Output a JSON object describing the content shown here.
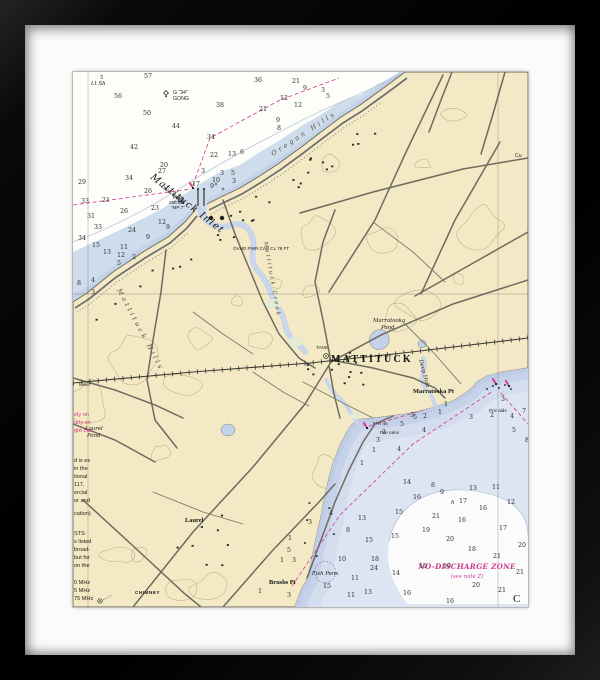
{
  "artwork": {
    "type_note": "framed nautical chart print",
    "frame_color": "#0c0c0c",
    "mat_color": "#fbfbfa",
    "colors": {
      "land": "#f3e9c4",
      "shallow_sound": "#cfdcec",
      "bay_pale": "#dde4f2",
      "bay_shallow": "#c6d2e9",
      "creek": "#c8d5ea",
      "marsh": "#e3ecd2",
      "magenta": "#cf3a8e",
      "road": "#6f6b60",
      "contour": "#b1a67c"
    }
  },
  "chart": {
    "labels": [
      {
        "t": "Mattituck Inlet",
        "x": 77,
        "y": 106,
        "cls": "inlet",
        "rot": 38
      },
      {
        "t": "(see inset)",
        "x": 88,
        "y": 115,
        "cls": "tiny-it",
        "rot": 38
      },
      {
        "t": "G “34”",
        "x": 100,
        "y": 22,
        "cls": "tiny"
      },
      {
        "t": "GONG",
        "x": 100,
        "y": 28,
        "cls": "tiny"
      },
      {
        "t": "5",
        "x": 27,
        "y": 7,
        "cls": "sd2"
      },
      {
        "t": "Lt Sh",
        "x": 18,
        "y": 13,
        "cls": "tiny-it"
      },
      {
        "t": "Fl 4s",
        "x": 100,
        "y": 127,
        "cls": "tiny4"
      },
      {
        "t": "25ft 6M",
        "x": 96,
        "y": 132,
        "cls": "tiny4"
      },
      {
        "t": "“MP 7”",
        "x": 98,
        "y": 137,
        "cls": "tiny4"
      },
      {
        "t": "Oregon Hills",
        "x": 200,
        "y": 84,
        "cls": "spread",
        "rot": -33
      },
      {
        "t": "Mattituck Hills",
        "x": 44,
        "y": 218,
        "cls": "spread",
        "rot": 62
      },
      {
        "t": "Mattituck Creek",
        "x": 191,
        "y": 170,
        "cls": "spread2",
        "rot": 80
      },
      {
        "t": "OVHD PWR CAB CL 78 FT",
        "x": 160,
        "y": 178,
        "cls": "tiny4"
      },
      {
        "t": "MATTITUCK",
        "x": 258,
        "y": 290,
        "cls": "town"
      },
      {
        "t": "TANK",
        "x": 243,
        "y": 277,
        "cls": "tiny4"
      },
      {
        "t": "Marratooka",
        "x": 300,
        "y": 250,
        "cls": "tiny-it"
      },
      {
        "t": "Pond",
        "x": 308,
        "y": 257,
        "cls": "tiny-it"
      },
      {
        "t": "Marratooka Pt",
        "x": 340,
        "y": 321,
        "cls": "ptlabel"
      },
      {
        "t": "Deep Hole",
        "x": 346,
        "y": 288,
        "cls": "tiny-it",
        "rot": 75
      },
      {
        "t": "Priv aids",
        "x": 416,
        "y": 340,
        "cls": "tiny4"
      },
      {
        "t": "Pile ruins",
        "x": 307,
        "y": 362,
        "cls": "tiny4"
      },
      {
        "t": "Fl R 4s",
        "x": 300,
        "y": 353,
        "cls": "tiny4"
      },
      {
        "t": "Brushs Pt",
        "x": 196,
        "y": 512,
        "cls": "ptlabel"
      },
      {
        "t": "Laurel",
        "x": 112,
        "y": 450,
        "cls": "ptlabel"
      },
      {
        "t": "Laurel",
        "x": 12,
        "y": 358,
        "cls": "tiny-it"
      },
      {
        "t": "Pond",
        "x": 14,
        "y": 365,
        "cls": "tiny-it"
      },
      {
        "t": "Fish Pens",
        "x": 252,
        "y": 503,
        "cls": "tiny-it",
        "a": "m"
      },
      {
        "t": "NO-DISCHARGE ZONE",
        "x": 394,
        "y": 497,
        "cls": "ndz",
        "a": "m"
      },
      {
        "t": "(see note Z)",
        "x": 394,
        "y": 506,
        "cls": "ndz2",
        "a": "m"
      },
      {
        "t": "CHIMNEY",
        "x": 62,
        "y": 522,
        "cls": "tiny4b"
      },
      {
        "t": "tower",
        "x": 6,
        "y": 314,
        "cls": "tiny4"
      },
      {
        "t": "Cu",
        "x": 442,
        "y": 85,
        "cls": "tiny"
      },
      {
        "t": "C",
        "x": 440,
        "y": 530,
        "cls": "bigC"
      },
      {
        "t": "ely on",
        "x": 1,
        "y": 344,
        "cls": "notem"
      },
      {
        "t": "arly on",
        "x": 1,
        "y": 352,
        "cls": "notem"
      },
      {
        "t": "ght List",
        "x": 1,
        "y": 360,
        "cls": "notem"
      },
      {
        "t": "d is es",
        "x": 1,
        "y": 390,
        "cls": "note"
      },
      {
        "t": "in the",
        "x": 1,
        "y": 398,
        "cls": "note"
      },
      {
        "t": "tional",
        "x": 1,
        "y": 406,
        "cls": "note"
      },
      {
        "t": "117,",
        "x": 1,
        "y": 414,
        "cls": "note"
      },
      {
        "t": "ercial",
        "x": 1,
        "y": 422,
        "cls": "note"
      },
      {
        "t": "or and",
        "x": 1,
        "y": 430,
        "cls": "note"
      },
      {
        "t": "cation)",
        "x": 1,
        "y": 443,
        "cls": "note"
      },
      {
        "t": "STS",
        "x": 1,
        "y": 463,
        "cls": "note"
      },
      {
        "t": "s listed",
        "x": 1,
        "y": 471,
        "cls": "note"
      },
      {
        "t": "broad-",
        "x": 1,
        "y": 479,
        "cls": "note"
      },
      {
        "t": "but for",
        "x": 1,
        "y": 487,
        "cls": "note"
      },
      {
        "t": "on the",
        "x": 1,
        "y": 495,
        "cls": "note"
      },
      {
        "t": "0 MHz",
        "x": 1,
        "y": 512,
        "cls": "note"
      },
      {
        "t": "5 MHz",
        "x": 1,
        "y": 520,
        "cls": "note"
      },
      {
        "t": "75 MHz",
        "x": 1,
        "y": 528,
        "cls": "note"
      },
      {
        "t": "h",
        "x": 378,
        "y": 432,
        "cls": "tiny-it"
      }
    ],
    "soundings": [
      {
        "v": "57",
        "x": 71,
        "y": 6
      },
      {
        "v": "56",
        "x": 41,
        "y": 26
      },
      {
        "v": "50",
        "x": 70,
        "y": 43
      },
      {
        "v": "44",
        "x": 99,
        "y": 56
      },
      {
        "v": "42",
        "x": 57,
        "y": 77
      },
      {
        "v": "38",
        "x": 143,
        "y": 35
      },
      {
        "v": "36",
        "x": 181,
        "y": 10
      },
      {
        "v": "21",
        "x": 219,
        "y": 11
      },
      {
        "v": "21",
        "x": 186,
        "y": 39
      },
      {
        "v": "12",
        "x": 207,
        "y": 28
      },
      {
        "v": "12",
        "x": 221,
        "y": 35
      },
      {
        "v": "9",
        "x": 203,
        "y": 50
      },
      {
        "v": "8",
        "x": 204,
        "y": 58
      },
      {
        "v": "34",
        "x": 134,
        "y": 67
      },
      {
        "v": "22",
        "x": 137,
        "y": 85
      },
      {
        "v": "13",
        "x": 155,
        "y": 84
      },
      {
        "v": "6",
        "x": 167,
        "y": 82
      },
      {
        "v": "20",
        "x": 87,
        "y": 95
      },
      {
        "v": "27",
        "x": 85,
        "y": 101
      },
      {
        "v": "34",
        "x": 52,
        "y": 108
      },
      {
        "v": "26",
        "x": 71,
        "y": 121
      },
      {
        "v": "21",
        "x": 29,
        "y": 130
      },
      {
        "v": "33",
        "x": 8,
        "y": 131
      },
      {
        "v": "29",
        "x": 5,
        "y": 112
      },
      {
        "v": "31",
        "x": 14,
        "y": 146
      },
      {
        "v": "23",
        "x": 78,
        "y": 138
      },
      {
        "v": "26",
        "x": 47,
        "y": 141
      },
      {
        "v": "24",
        "x": 55,
        "y": 160
      },
      {
        "v": "33",
        "x": 21,
        "y": 157
      },
      {
        "v": "34",
        "x": 5,
        "y": 168
      },
      {
        "v": "15",
        "x": 19,
        "y": 175
      },
      {
        "v": "13",
        "x": 30,
        "y": 182
      },
      {
        "v": "12",
        "x": 44,
        "y": 185
      },
      {
        "v": "11",
        "x": 47,
        "y": 177
      },
      {
        "v": "5",
        "x": 44,
        "y": 193
      },
      {
        "v": "2",
        "x": 59,
        "y": 187
      },
      {
        "v": "9",
        "x": 93,
        "y": 157
      },
      {
        "v": "12",
        "x": 85,
        "y": 152
      },
      {
        "v": "9",
        "x": 73,
        "y": 167
      },
      {
        "v": "8",
        "x": 4,
        "y": 213
      },
      {
        "v": "4",
        "x": 18,
        "y": 210
      },
      {
        "v": "3",
        "x": 18,
        "y": 222
      },
      {
        "v": "17",
        "x": 119,
        "y": 114
      },
      {
        "v": "3",
        "x": 128,
        "y": 101
      },
      {
        "v": "10",
        "x": 139,
        "y": 110
      },
      {
        "v": "9",
        "x": 137,
        "y": 116
      },
      {
        "v": "3",
        "x": 147,
        "y": 103
      },
      {
        "v": "5",
        "x": 158,
        "y": 103
      },
      {
        "v": "3",
        "x": 159,
        "y": 111
      },
      {
        "v": "21",
        "x": 104,
        "y": 130
      },
      {
        "v": "3",
        "x": 248,
        "y": 20
      },
      {
        "v": "5",
        "x": 253,
        "y": 26
      },
      {
        "v": "9",
        "x": 230,
        "y": 18
      },
      {
        "v": "14",
        "x": 330,
        "y": 412
      },
      {
        "v": "8",
        "x": 358,
        "y": 415
      },
      {
        "v": "9",
        "x": 367,
        "y": 422
      },
      {
        "v": "13",
        "x": 396,
        "y": 418
      },
      {
        "v": "11",
        "x": 419,
        "y": 417
      },
      {
        "v": "16",
        "x": 340,
        "y": 427
      },
      {
        "v": "17",
        "x": 386,
        "y": 431
      },
      {
        "v": "16",
        "x": 406,
        "y": 438
      },
      {
        "v": "12",
        "x": 434,
        "y": 432
      },
      {
        "v": "21",
        "x": 359,
        "y": 446
      },
      {
        "v": "16",
        "x": 385,
        "y": 450
      },
      {
        "v": "19",
        "x": 349,
        "y": 460
      },
      {
        "v": "17",
        "x": 426,
        "y": 458
      },
      {
        "v": "20",
        "x": 373,
        "y": 469
      },
      {
        "v": "20",
        "x": 445,
        "y": 475
      },
      {
        "v": "18",
        "x": 395,
        "y": 479
      },
      {
        "v": "21",
        "x": 420,
        "y": 486
      },
      {
        "v": "16",
        "x": 346,
        "y": 496
      },
      {
        "v": "19",
        "x": 370,
        "y": 496
      },
      {
        "v": "21",
        "x": 443,
        "y": 502
      },
      {
        "v": "20",
        "x": 399,
        "y": 515
      },
      {
        "v": "21",
        "x": 425,
        "y": 520
      },
      {
        "v": "16",
        "x": 373,
        "y": 531
      },
      {
        "v": "16",
        "x": 330,
        "y": 523
      },
      {
        "v": "3",
        "x": 235,
        "y": 452
      },
      {
        "v": "4",
        "x": 256,
        "y": 443
      },
      {
        "v": "8",
        "x": 273,
        "y": 460
      },
      {
        "v": "13",
        "x": 285,
        "y": 448
      },
      {
        "v": "15",
        "x": 322,
        "y": 442
      },
      {
        "v": "1",
        "x": 215,
        "y": 468
      },
      {
        "v": "15",
        "x": 292,
        "y": 470
      },
      {
        "v": "15",
        "x": 318,
        "y": 466
      },
      {
        "v": "5",
        "x": 214,
        "y": 480
      },
      {
        "v": "1",
        "x": 207,
        "y": 490
      },
      {
        "v": "3",
        "x": 219,
        "y": 490
      },
      {
        "v": "10",
        "x": 265,
        "y": 489
      },
      {
        "v": "24",
        "x": 297,
        "y": 498
      },
      {
        "v": "14",
        "x": 319,
        "y": 503
      },
      {
        "v": "18",
        "x": 298,
        "y": 489
      },
      {
        "v": "11",
        "x": 278,
        "y": 508
      },
      {
        "v": "15",
        "x": 250,
        "y": 516
      },
      {
        "v": "11",
        "x": 274,
        "y": 525
      },
      {
        "v": "13",
        "x": 291,
        "y": 522
      },
      {
        "v": "3",
        "x": 214,
        "y": 525
      },
      {
        "v": "1",
        "x": 185,
        "y": 521
      },
      {
        "v": "1",
        "x": 371,
        "y": 334
      },
      {
        "v": "3",
        "x": 337,
        "y": 345
      },
      {
        "v": "2",
        "x": 350,
        "y": 346
      },
      {
        "v": "3",
        "x": 396,
        "y": 347
      },
      {
        "v": "5",
        "x": 327,
        "y": 354
      },
      {
        "v": "4",
        "x": 349,
        "y": 360
      },
      {
        "v": "1",
        "x": 365,
        "y": 342
      },
      {
        "v": "2",
        "x": 417,
        "y": 345
      },
      {
        "v": "3",
        "x": 428,
        "y": 329
      },
      {
        "v": "4",
        "x": 324,
        "y": 379
      },
      {
        "v": "1",
        "x": 287,
        "y": 393
      },
      {
        "v": "7",
        "x": 449,
        "y": 341
      },
      {
        "v": "4",
        "x": 437,
        "y": 346
      },
      {
        "v": "5",
        "x": 439,
        "y": 360
      },
      {
        "v": "8",
        "x": 452,
        "y": 370
      },
      {
        "v": "2",
        "x": 309,
        "y": 362
      },
      {
        "v": "3",
        "x": 303,
        "y": 370
      },
      {
        "v": "1",
        "x": 299,
        "y": 380
      },
      {
        "v": "5",
        "x": 340,
        "y": 347
      }
    ],
    "symbols": [
      {
        "n": "light-flare",
        "x": 120,
        "y": 116
      },
      {
        "n": "light-flare",
        "x": 294,
        "y": 356
      },
      {
        "n": "gong-buoy",
        "x": 93,
        "y": 21
      },
      {
        "n": "tank",
        "x": 138,
        "y": 146
      },
      {
        "n": "tank",
        "x": 149,
        "y": 146
      },
      {
        "n": "water-tower",
        "x": 253,
        "y": 284
      },
      {
        "n": "chimney",
        "x": 27,
        "y": 529
      },
      {
        "n": "fish-pens-circle",
        "x": 252,
        "y": 500
      },
      {
        "n": "pile",
        "x": 420,
        "y": 314
      },
      {
        "n": "pile",
        "x": 426,
        "y": 316
      },
      {
        "n": "pile",
        "x": 432,
        "y": 313
      },
      {
        "n": "pile",
        "x": 438,
        "y": 317
      },
      {
        "n": "pile",
        "x": 414,
        "y": 317
      },
      {
        "n": "light-flare",
        "x": 423,
        "y": 312
      },
      {
        "n": "light-flare",
        "x": 436,
        "y": 314
      },
      {
        "n": "rock",
        "x": 143,
        "y": 112
      },
      {
        "n": "rock",
        "x": 150,
        "y": 117
      },
      {
        "n": "jetty-dot",
        "x": 125,
        "y": 117
      },
      {
        "n": "jetty-dot",
        "x": 131,
        "y": 117
      }
    ]
  }
}
